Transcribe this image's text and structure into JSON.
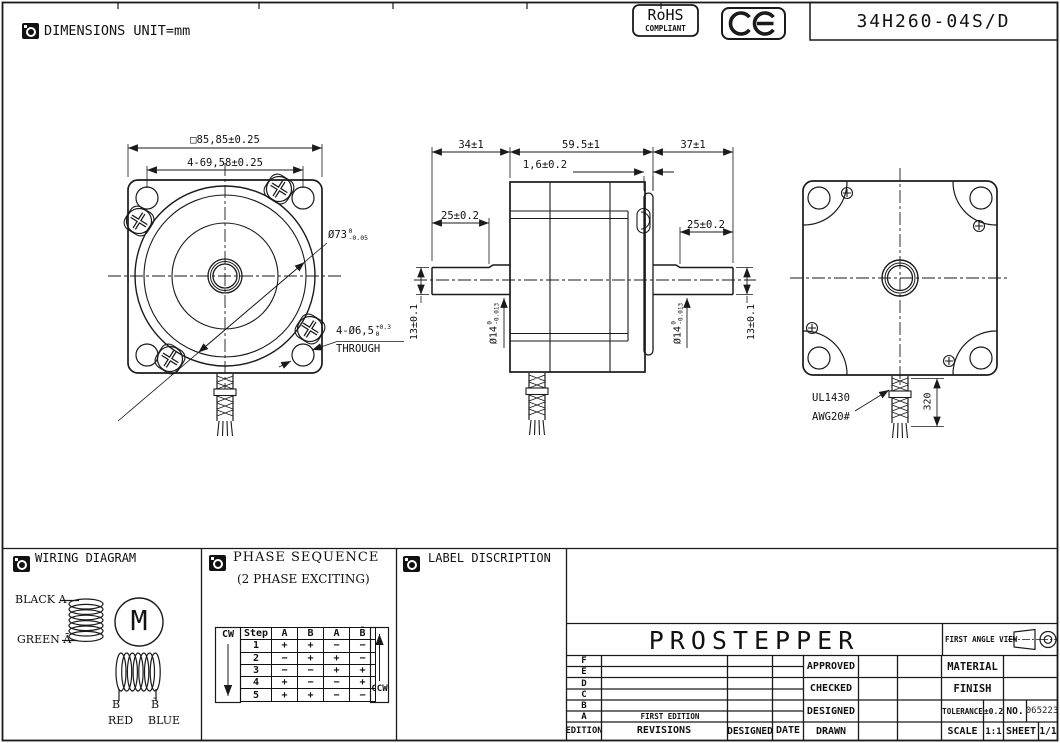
{
  "colors": {
    "ink": "#1a1a1a",
    "paper": "#ffffff"
  },
  "header": {
    "unit_note": "DIMENSIONS UNIT=mm",
    "rohs_title": "RoHS",
    "rohs_sub": "COMPLIANT",
    "ce_mark": "CE",
    "part_number": "34H260-04S/D"
  },
  "front_view": {
    "dim_square": "□85,85±0.25",
    "dim_bolt_circle": "4-69,58±0.25",
    "pilot_dia": "Ø73",
    "pilot_tol_top": "0",
    "pilot_tol_bot": "-0.05",
    "holes_dia": "4-Ø6,5",
    "holes_tol_top": "+0.3",
    "holes_tol_bot": "0",
    "holes_note": "THROUGH"
  },
  "side_view": {
    "front_shaft_len": "34±1",
    "body_len": "59.5±1",
    "rear_shaft_len": "37±1",
    "plate_thickness": "1,6±0.2",
    "front_flat_len": "25±0.2",
    "rear_flat_len": "25±0.2",
    "front_flat_height": "13±0.1",
    "rear_flat_height": "13±0.1",
    "front_shaft_dia": "Ø14",
    "front_shaft_tol_top": "0",
    "front_shaft_tol_bot": "-0.013",
    "rear_shaft_dia": "Ø14",
    "rear_shaft_tol_top": "0",
    "rear_shaft_tol_bot": "-0.013"
  },
  "back_view": {
    "lead_wire_spec_1": "UL1430",
    "lead_wire_spec_2": "AWG20#",
    "lead_wire_length": "320"
  },
  "wiring": {
    "title": "WIRING DIAGRAM",
    "lead_a": "BLACK A",
    "lead_a_bar": "GREEN Ā",
    "motor": "M",
    "lead_b": "B",
    "lead_b_bar": "B̄",
    "lead_b_color": "RED",
    "lead_b_bar_color": "BLUE"
  },
  "phase": {
    "title": "PHASE SEQUENCE",
    "subtitle": "(2 PHASE EXCITING)",
    "cw": "CW",
    "ccw": "CCW",
    "headers": [
      "Step",
      "A",
      "B",
      "Ā",
      "B̄"
    ],
    "rows": [
      [
        "1",
        "+",
        "+",
        "−",
        "−"
      ],
      [
        "2",
        "−",
        "+",
        "+",
        "−"
      ],
      [
        "3",
        "−",
        "−",
        "+",
        "+"
      ],
      [
        "4",
        "+",
        "−",
        "−",
        "+"
      ],
      [
        "5",
        "+",
        "+",
        "−",
        "−"
      ]
    ]
  },
  "label_section": {
    "title": "LABEL DISCRIPTION"
  },
  "title_block": {
    "company": "PROSTEPPER",
    "first_angle_view": "FIRST ANGLE VIEW",
    "rev_letters": [
      "F",
      "E",
      "D",
      "C",
      "B",
      "A"
    ],
    "edition": "EDITION",
    "revisions": "REVISIONS",
    "designed_col": "DESIGNED",
    "date_col": "DATE",
    "first_edition": "FIRST EDITION",
    "approved": "APPROVED",
    "checked": "CHECKED",
    "designed": "DESIGNED",
    "drawn": "DRAWN",
    "material": "MATERIAL",
    "finish": "FINISH",
    "tolerance_label": "TOLERANCE",
    "tolerance_value": "±0.2",
    "no_label": "NO.",
    "no_value": "065223",
    "scale_label": "SCALE",
    "scale_value": "1:1",
    "sheet_label": "SHEET",
    "sheet_value": "1/1"
  }
}
